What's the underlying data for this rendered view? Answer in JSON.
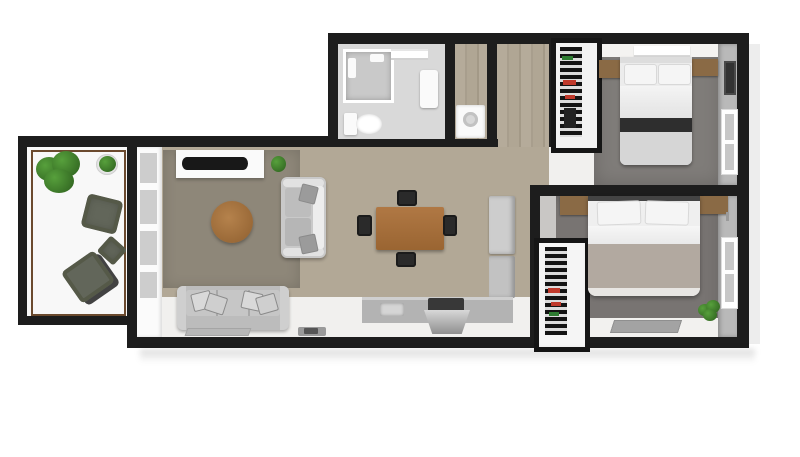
{
  "meta": {
    "type": "3d-floor-plan-top-view",
    "style": "rendered-architectural-visualization",
    "visible_text": "none"
  },
  "colors": {
    "wall": "#1d1d1d",
    "background": "#ffffff",
    "wood_floor": "#b2a896",
    "rug": "#8e8779",
    "balcony_floor": "#f8f8f8",
    "balcony_rail": "#6b4a2e",
    "bedroom_carpet": "#7f7c79",
    "wall_face_gray": "#b9b9b9",
    "bath_floor": "#d9d9d9",
    "wood_furniture": "#8a6a45",
    "dining_table_wood": "#a8713d",
    "coffee_table_wood": "#a5743f",
    "sofa_gray": "#bcbcbc",
    "loveseat_gray": "#c9c9c9",
    "counter_gray": "#b3b3b3",
    "fridge_gray": "#cdcdcd",
    "cooktop_dark": "#383838",
    "bed1_dark_band": "#2e2e2e",
    "bed1_lower_duvet": "#d6d6d6",
    "bed2_duvet": "#b2a9a0",
    "plant_green": "#3f7a2d",
    "closet_accent_red": "#c0392b",
    "closet_accent_green": "#2e7d32",
    "olive_chair": "#62665a",
    "mat_gray": "#a3a3a3"
  },
  "rooms": [
    {
      "name": "balcony",
      "furniture": [
        "potted-plant-large",
        "potted-plant-small",
        "lounge-chair",
        "lounge-chair",
        "side-table"
      ]
    },
    {
      "name": "living-room",
      "furniture": [
        "tv-console",
        "tv",
        "area-rug",
        "round-coffee-table",
        "loveseat",
        "three-seat-sofa",
        "floor-mats",
        "small-plant",
        "french-door-windows"
      ]
    },
    {
      "name": "dining-area",
      "furniture": [
        "dining-table",
        "chair",
        "chair",
        "chair",
        "chair"
      ]
    },
    {
      "name": "kitchen",
      "furniture": [
        "refrigerator",
        "counter",
        "sink",
        "cooktop"
      ]
    },
    {
      "name": "bathroom",
      "furniture": [
        "shower",
        "toilet",
        "towel-shelf",
        "door"
      ]
    },
    {
      "name": "laundry-nook",
      "furniture": [
        "washer"
      ]
    },
    {
      "name": "hallway",
      "furniture": []
    },
    {
      "name": "closet-1",
      "furniture": [
        "shelf-rack"
      ]
    },
    {
      "name": "closet-2",
      "furniture": [
        "shelf-rack"
      ]
    },
    {
      "name": "bedroom-1",
      "furniture": [
        "double-bed",
        "nightstand",
        "nightstand",
        "headboard-shelf",
        "wall-tv",
        "window"
      ]
    },
    {
      "name": "bedroom-2",
      "furniture": [
        "double-bed",
        "nightstand",
        "nightstand",
        "floor-mat",
        "potted-plant",
        "window"
      ]
    }
  ]
}
